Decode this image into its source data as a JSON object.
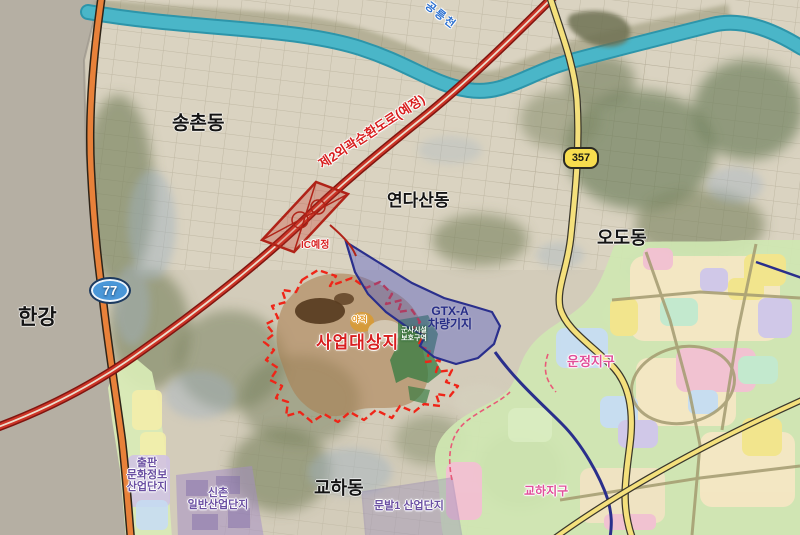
{
  "map": {
    "region_labels": {
      "hangang": "한강",
      "songchon": "송촌동",
      "yeondasan": "연다산동",
      "odo": "오도동",
      "gyohadong": "교하동"
    },
    "road_labels": {
      "ring_road": "제2외곽순환도로(예정)",
      "ic": "IC예정",
      "route77": "77",
      "route357": "357"
    },
    "water_labels": {
      "stream": "공릉천"
    },
    "project": {
      "site": "사업대상지",
      "gtx_line1": "GTX-A",
      "gtx_line2": "차량기지",
      "yard": "야적",
      "green_line1": "군사시설",
      "green_line2": "보호구역"
    },
    "districts": {
      "unjeong": "운정지구",
      "gyoha": "교하지구",
      "chulpan_line1": "출판",
      "chulpan_line2": "문화정보",
      "chulpan_line3": "산업단지",
      "sinchon_line1": "신촌",
      "sinchon_line2": "일반산업단지",
      "munbal": "문발1 산업단지"
    },
    "colors": {
      "site_boundary": "#ef2518",
      "site_fill": "#aa7d50",
      "depot_fill": "#565ec8",
      "depot_border": "#2a2f8c",
      "route77_shield": "#4a97d8",
      "route357_shield": "#f7dd4e",
      "expressway_orange": "#e8813a",
      "ring_expressway_red": "#cc3527",
      "stream_teal": "#45b3c6",
      "hangang_gray": "#b5afa3",
      "district_green": "#cfe7b2"
    }
  }
}
